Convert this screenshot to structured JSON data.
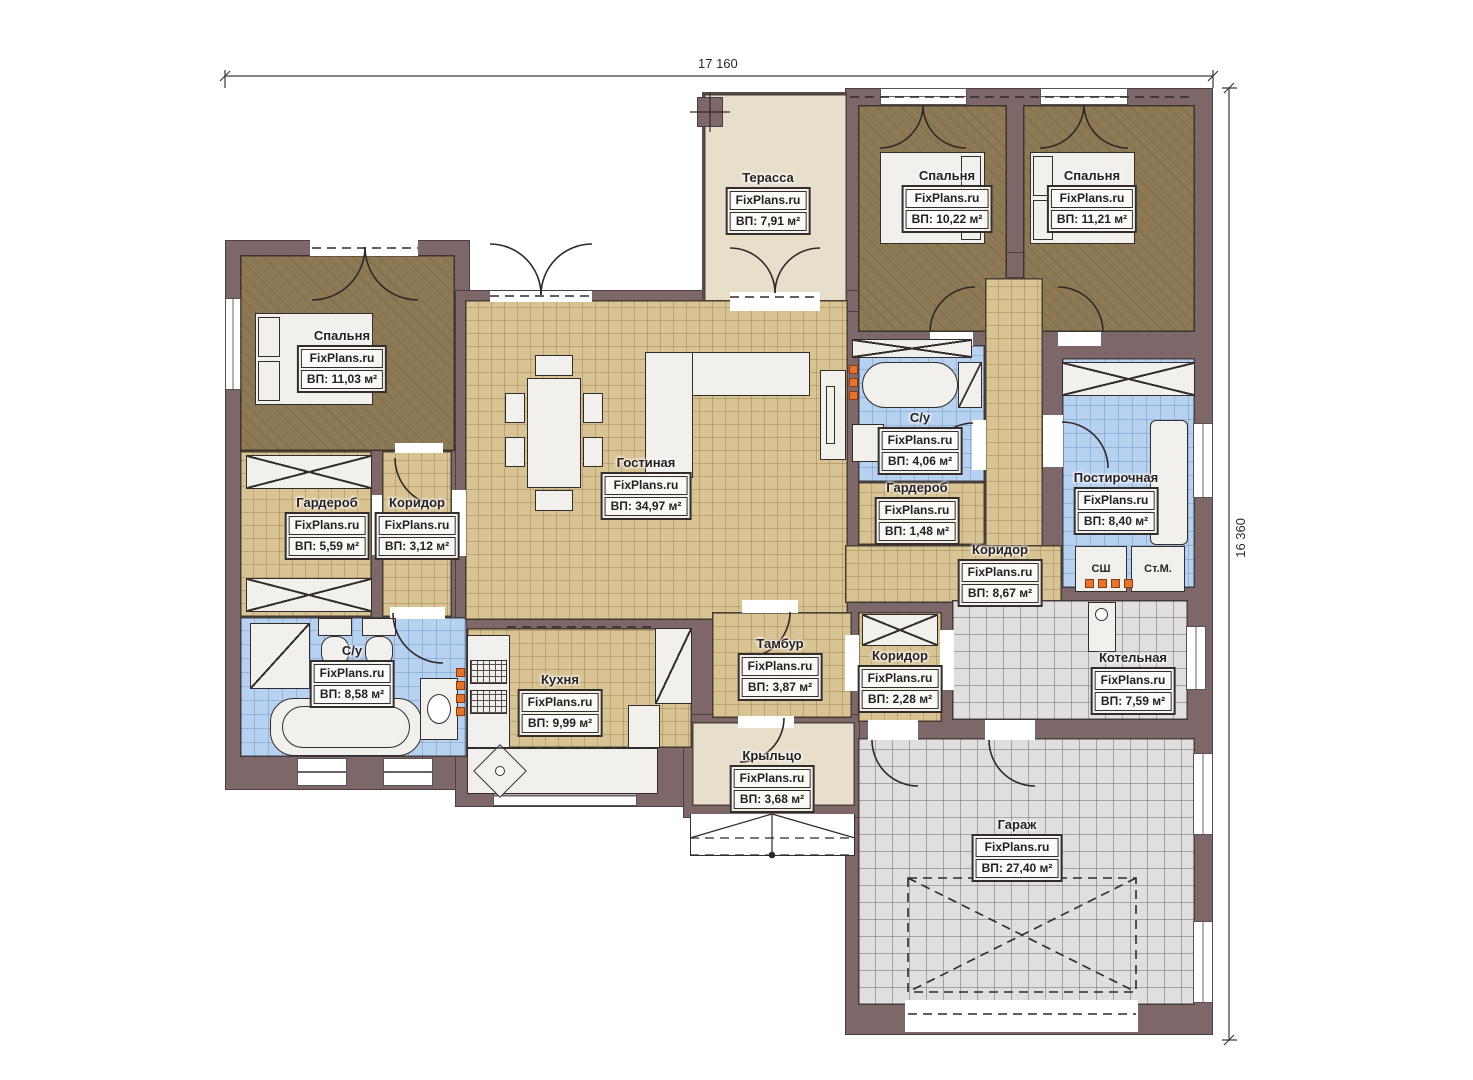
{
  "watermark": "FixPlans.ru",
  "dimensions": {
    "width_label": "17 160",
    "height_label": "16 360"
  },
  "appliances": {
    "drying": "СШ",
    "washer": "Ст.М."
  },
  "rooms": [
    {
      "name": "Терасса",
      "area": "ВП: 7,91 м²"
    },
    {
      "name": "Спальня",
      "area": "ВП: 10,22 м²"
    },
    {
      "name": "Спальня",
      "area": "ВП: 11,21 м²"
    },
    {
      "name": "Спальня",
      "area": "ВП: 11,03 м²"
    },
    {
      "name": "Гостиная",
      "area": "ВП: 34,97 м²"
    },
    {
      "name": "С/у",
      "area": "ВП: 4,06 м²"
    },
    {
      "name": "Гардероб",
      "area": "ВП: 1,48 м²"
    },
    {
      "name": "Коридор",
      "area": "ВП: 8,67 м²"
    },
    {
      "name": "Постирочная",
      "area": "ВП: 8,40 м²"
    },
    {
      "name": "Гардероб",
      "area": "ВП: 5,59 м²"
    },
    {
      "name": "Коридор",
      "area": "ВП: 3,12 м²"
    },
    {
      "name": "С/у",
      "area": "ВП: 8,58 м²"
    },
    {
      "name": "Кухня",
      "area": "ВП: 9,99 м²"
    },
    {
      "name": "Тамбур",
      "area": "ВП: 3,87 м²"
    },
    {
      "name": "Коридор",
      "area": "ВП: 2,28 м²"
    },
    {
      "name": "Котельная",
      "area": "ВП: 7,59 м²"
    },
    {
      "name": "Крыльцо",
      "area": "ВП: 3,68 м²"
    },
    {
      "name": "Гараж",
      "area": "ВП: 27,40 м²"
    }
  ]
}
